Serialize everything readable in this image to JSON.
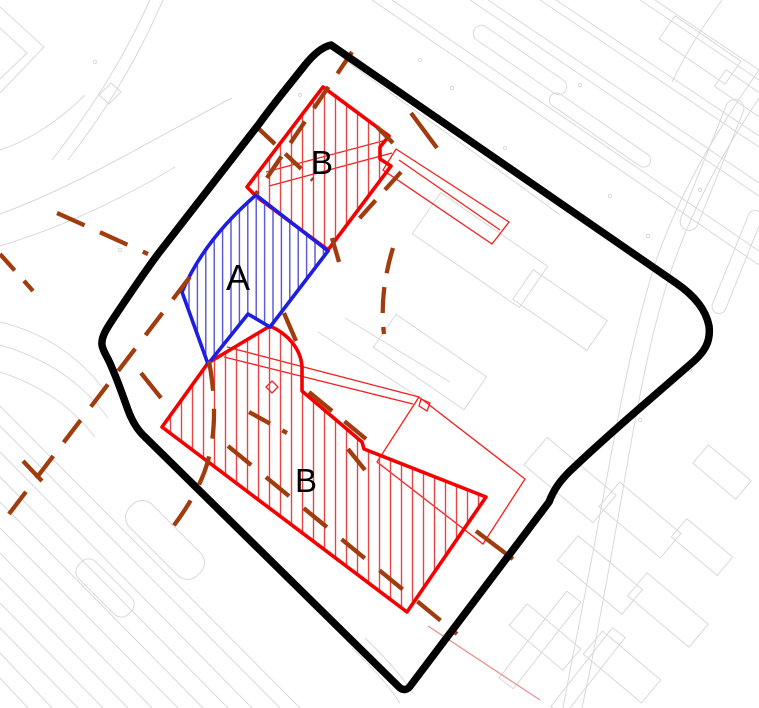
{
  "map": {
    "labels": {
      "zone_a": "A",
      "zone_b_upper": "B",
      "zone_b_lower": "B"
    },
    "colors": {
      "site_boundary": "#000000",
      "zone_a_outline": "#1e1ee0",
      "zone_a_hatch": "#5353d6",
      "zone_b_outline": "#f40000",
      "zone_b_hatch": "#e84444",
      "building_outline_thin": "#f42020",
      "dashed_line": "#a03c0e",
      "base_map_lines": "#d9d9d9",
      "label_text": "#000000"
    }
  }
}
